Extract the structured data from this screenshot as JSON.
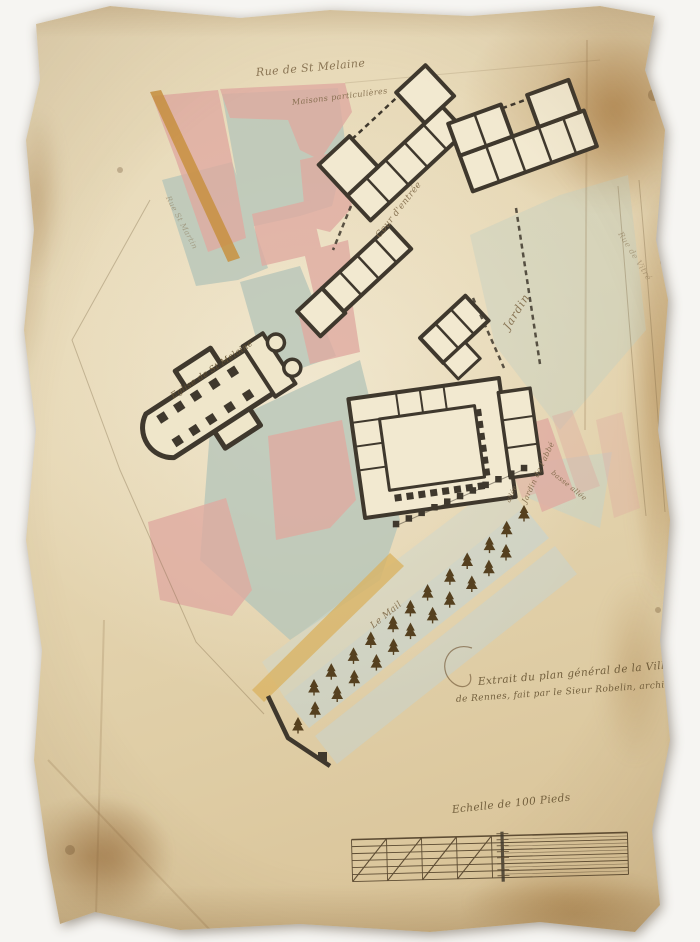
{
  "labels": {
    "street_top": "Rue de St Melaine",
    "houses": "Maisons particulières",
    "street_left": "Rue St Martin",
    "court": "Cour d'entrée",
    "garden": "Jardin",
    "church": "Eglise de St Melaine",
    "street_right": "Rue de Vitré",
    "abbots_garden": "Jardin de l'abbé",
    "lower_walk": "basse allée",
    "walk_small": "allée",
    "mall": "Le Mail",
    "caption_line1": "Extrait du plan général de la Ville",
    "caption_line2": "de Rennes, fait par le Sieur Robelin, architecte",
    "scale_caption": "Echelle de 100 Pieds"
  },
  "palette": {
    "paper": "#e7d8b4",
    "ink": "#3f382d",
    "wash_pink": "#dfa9a0",
    "wash_green": "#b7c6ba",
    "wash_blue": "#c5d4d2",
    "wash_yellow": "#d9b25f",
    "street_tan": "#c8913f",
    "script_ink": "#7d6746"
  }
}
